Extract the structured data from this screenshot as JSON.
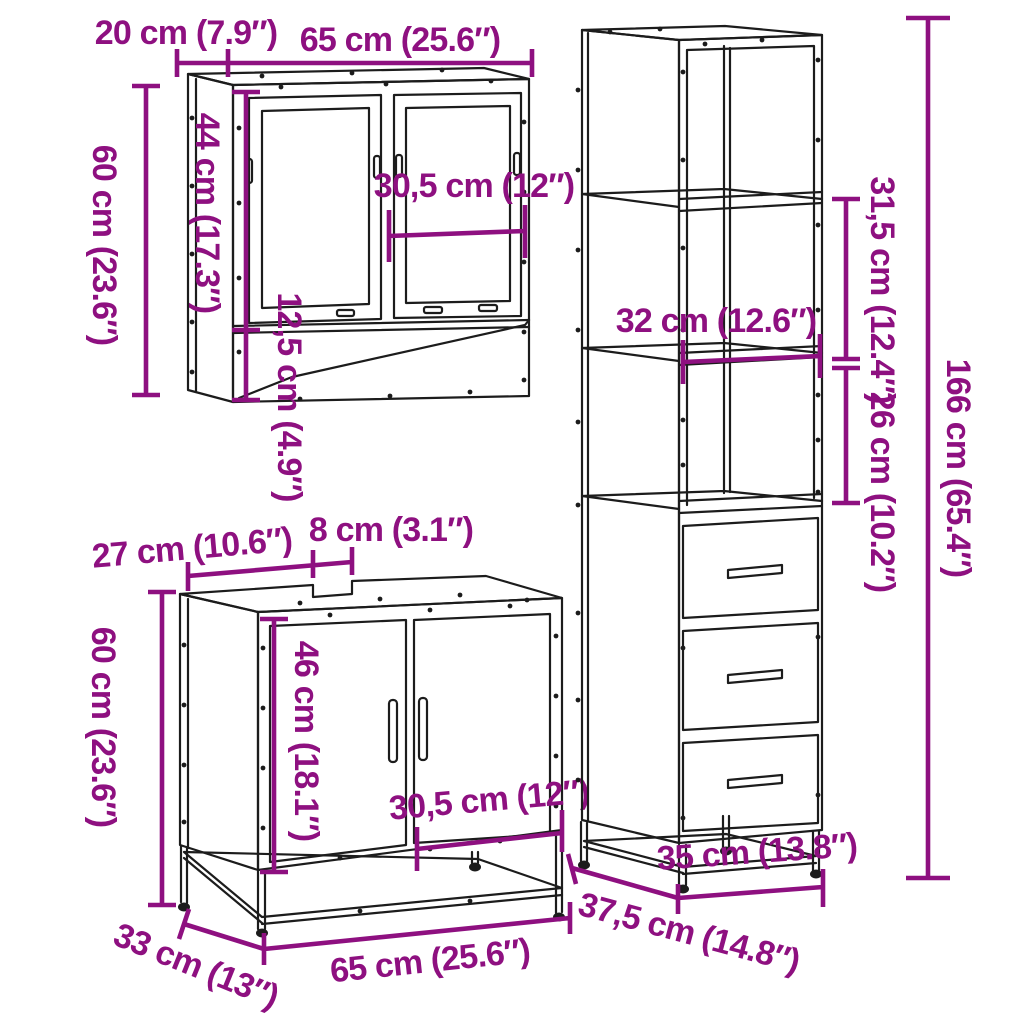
{
  "diagram": {
    "background": "#ffffff",
    "line_color": "#1c1c1c",
    "dim_color": "#8E1080",
    "mirror_cabinet": {
      "top_depth": "20 cm (7.9″)",
      "top_width": "65 cm (25.6″)",
      "height": "60 cm (23.6″)",
      "door_height": "44 cm (17.3″)",
      "inner_width": "30,5 cm (12″)",
      "shelf_height": "12,5 cm (4.9″)"
    },
    "sink_cabinet": {
      "top_depth_left": "27 cm (10.6″)",
      "notch_width": "8 cm (3.1″)",
      "height": "60 cm (23.6″)",
      "door_height": "46 cm (18.1″)",
      "inner_width": "30,5 cm (12″)",
      "width": "65 cm (25.6″)",
      "depth": "33 cm (13″)"
    },
    "tall_cabinet": {
      "upper_section_height": "31,5 cm (12.4″)",
      "total_height": "166 cm (65.4″)",
      "shelf_width": "32 cm (12.6″)",
      "middle_section_height": "26 cm (10.2″)",
      "width": "35 cm (13.8″)",
      "depth": "37,5 cm (14.8″)"
    }
  }
}
